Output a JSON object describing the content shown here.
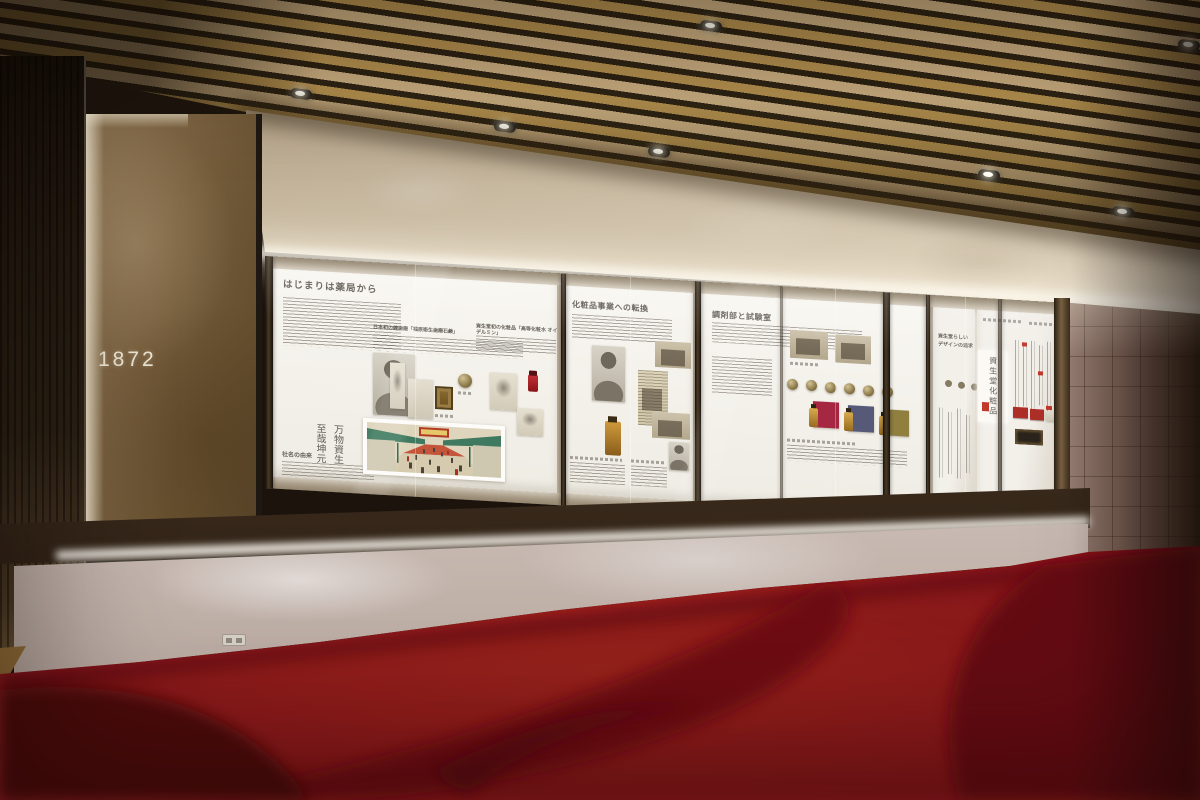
{
  "scene": {
    "description": "Corporate history museum wall exhibit photographed in a gallery",
    "wall_year": "1872",
    "panels": [
      {
        "heading": "はじまりは薬局から",
        "origin_heading": "社名の由来",
        "calligraphy": [
          "至哉坤元",
          "万物資生"
        ],
        "sub_headings": [
          "日本初の練歯磨「福原衛生歯磨石鹸」",
          "資生堂初の化粧品「高等化粧水 オイデルミン」"
        ]
      },
      {
        "heading": "化粧品事業への転換"
      },
      {
        "heading": "調剤部と試験室"
      },
      {
        "heading_lines": [
          "資生堂らしい",
          "デザインの追求"
        ],
        "poster_title": "資生堂化粧品"
      }
    ],
    "colors": {
      "carpet_red": "#A01920",
      "carpet_dark": "#7A1014",
      "ceiling_wood_light": "#C7AB7E",
      "ceiling_wood_gold": "#B28F4E",
      "upper_wall_beige": "#CEC0A8",
      "gold_panel": "#79603F",
      "plaster_wall": "#E9DFD6",
      "exhibit_panel_white": "#F8F6F1",
      "frame_bronze": "#3A2C1D",
      "tile_wall_mauve": "#84695C"
    }
  }
}
